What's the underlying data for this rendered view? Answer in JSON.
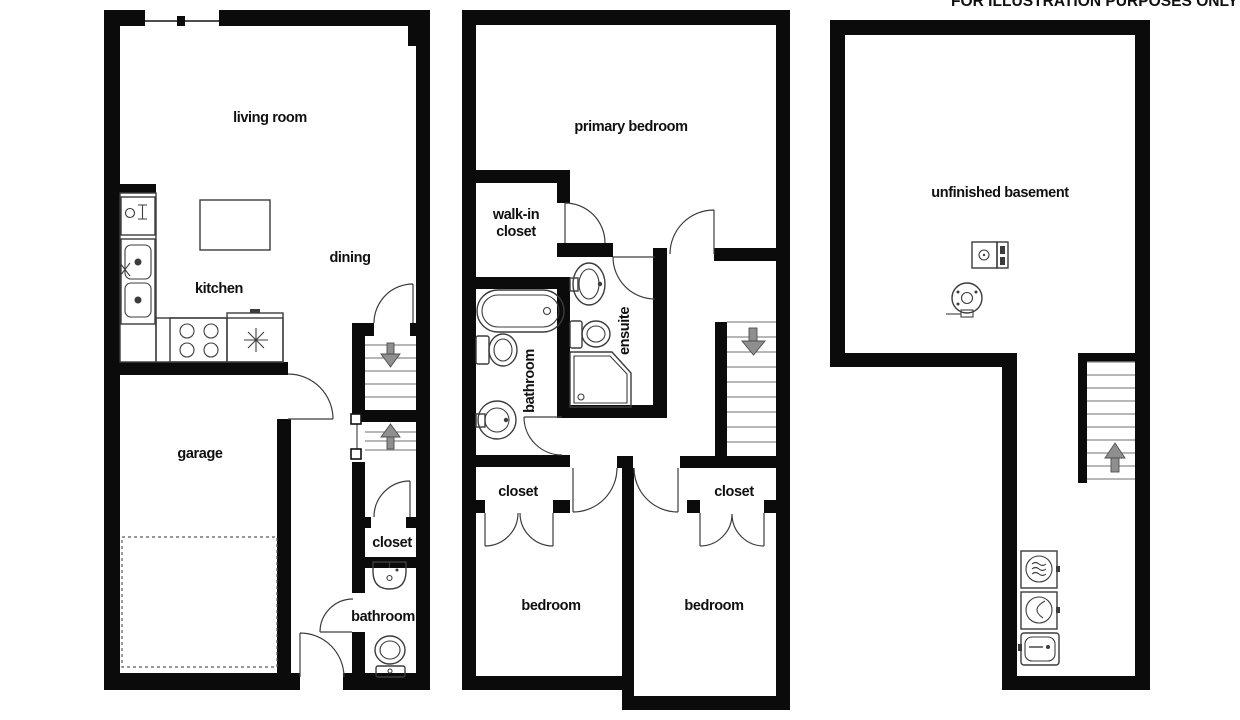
{
  "disclaimer": "FOR ILLUSTRATION PURPOSES ONLY",
  "colors": {
    "bg": "#ffffff",
    "wall": "#0b0b0b",
    "fixture": "#3c3c3c",
    "tread": "#8c8c8c",
    "arrow": "#8f8f8f"
  },
  "floor_main": {
    "labels": {
      "living_room": "living room",
      "dining": "dining",
      "kitchen": "kitchen",
      "garage": "garage",
      "closet": "closet",
      "bathroom": "bathroom"
    },
    "fixtures": [
      "window",
      "dishwasher-icon",
      "double-sink-icon",
      "stove-icon",
      "fridge-icon",
      "kitchen-island",
      "stairs-down",
      "stairs-up",
      "car-pad",
      "sink-icon",
      "toilet-icon"
    ]
  },
  "floor_upper": {
    "labels": {
      "primary_bedroom": "primary bedroom",
      "walk_in_line1": "walk-in",
      "walk_in_line2": "closet",
      "bathroom": "bathroom",
      "ensuite": "ensuite",
      "closet_left": "closet",
      "closet_right": "closet",
      "bedroom_left": "bedroom",
      "bedroom_right": "bedroom"
    },
    "fixtures": [
      "bathtub-icon",
      "toilet-icon",
      "pedestal-sink-icon",
      "ensuite-sink-icon",
      "ensuite-toilet-icon",
      "corner-shower-icon",
      "stairs-down"
    ]
  },
  "floor_basement": {
    "labels": {
      "unfinished_basement": "unfinished basement"
    },
    "fixtures": [
      "furnace-icon",
      "water-heater-icon",
      "washer-icon",
      "dryer-icon",
      "laundry-tub-icon",
      "stairs-up"
    ]
  }
}
